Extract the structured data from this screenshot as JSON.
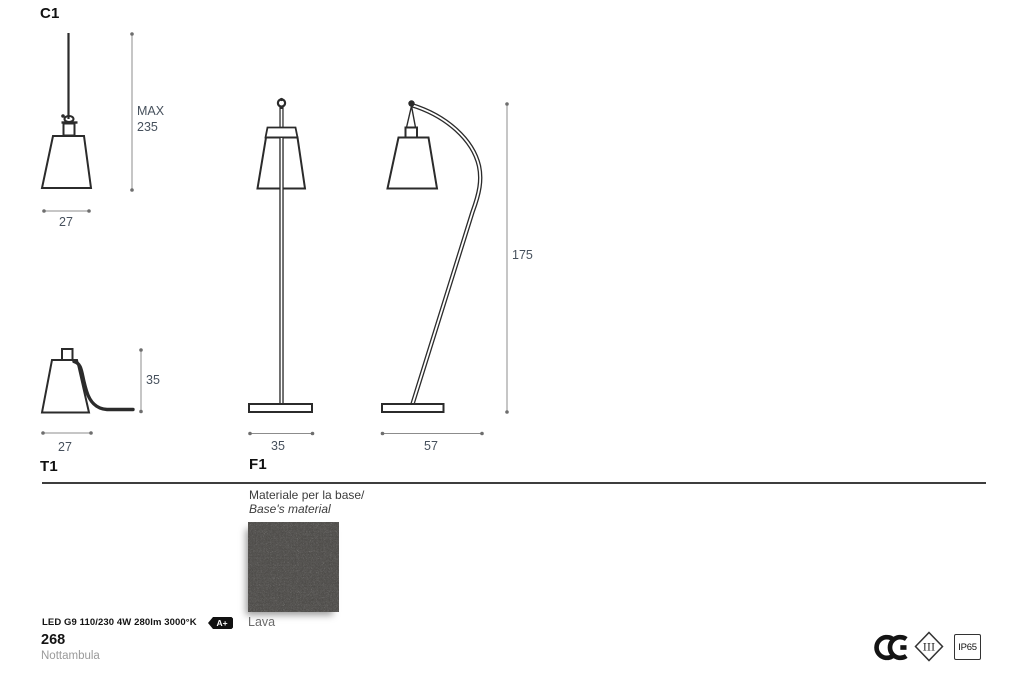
{
  "drawings": {
    "c1": {
      "label": "C1",
      "max_label": "MAX",
      "max_value": "235",
      "width": "27"
    },
    "t1": {
      "label": "T1",
      "height": "35",
      "width": "27"
    },
    "f1": {
      "label": "F1",
      "straight_width": "35",
      "arched_width": "57",
      "height": "175"
    }
  },
  "material": {
    "title_line1": "Materiale per la base/",
    "title_line2": "Base's material",
    "swatch_name": "Lava"
  },
  "specs": {
    "lamp": "LED G9 110/230 4W 280lm 3000°K",
    "energy_class": "A+"
  },
  "footer": {
    "page_number": "268",
    "product_name": "Nottambula"
  },
  "certifications": {
    "ce": "CE",
    "protection_class": "III",
    "ip_rating": "IP65"
  },
  "colors": {
    "outline": "#2b2b2b",
    "dimension_line": "#8c8c8c",
    "dimension_text": "#46505c",
    "swatch_base": "#4c4a47"
  }
}
